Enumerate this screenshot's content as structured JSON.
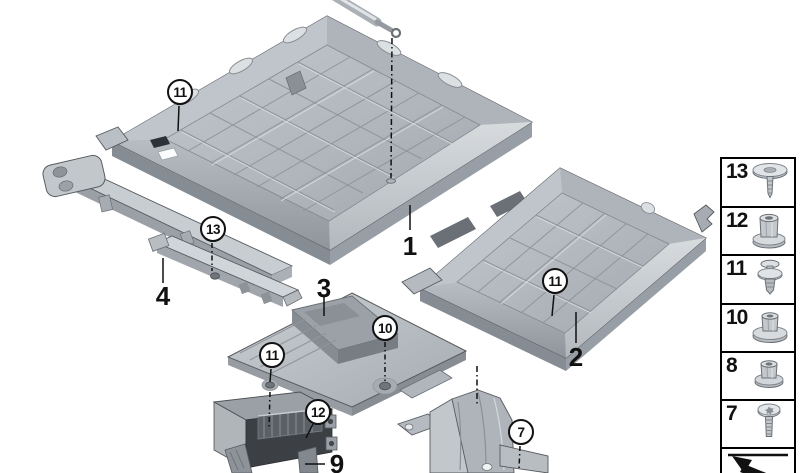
{
  "canvas": {
    "width": 800,
    "height": 473,
    "background": "#ffffff"
  },
  "diagram": {
    "kind": "exploded-parts-diagram",
    "part_labels": {
      "p1": "1",
      "p2": "2",
      "p3": "3",
      "p4": "4",
      "p9": "9"
    },
    "callouts": {
      "tray1_clip": "11",
      "rail_screw": "13",
      "bracket_clip": "11",
      "bracket_nut": "10",
      "box_nut": "12",
      "support_screw": "7",
      "tray2_clip": "11"
    }
  },
  "legend": {
    "items": [
      {
        "label": "13",
        "icon": "washer-screw-icon"
      },
      {
        "label": "12",
        "icon": "collar-nut-icon"
      },
      {
        "label": "11",
        "icon": "expansion-rivet-icon"
      },
      {
        "label": "10",
        "icon": "washer-nut-icon"
      },
      {
        "label": "8",
        "icon": "flange-nut-icon"
      },
      {
        "label": "7",
        "icon": "torx-screw-icon"
      },
      {
        "label": "",
        "icon": "direction-arrow-icon"
      }
    ]
  },
  "colors": {
    "line": "#111111",
    "part_light": "#dcе0e3",
    "part_mid": "#b4bac0",
    "part_dark": "#7d838a",
    "interior_dark": "#3c4045",
    "background": "#ffffff"
  }
}
